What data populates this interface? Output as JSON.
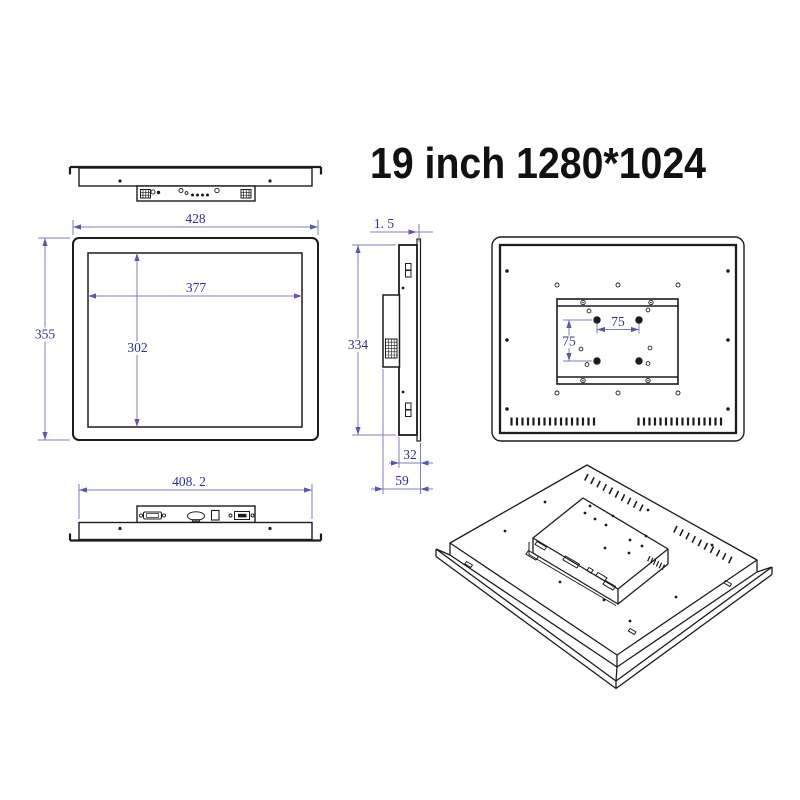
{
  "title": "19 inch 1280*1024",
  "colors": {
    "line": "#1c1c1c",
    "dim_line": "#7d7dc6",
    "dim_arrow": "#5757b5",
    "dim_text": "#2e2ea2",
    "title_text": "#111111",
    "background": "#ffffff"
  },
  "dims": {
    "front_width": "428",
    "front_height": "355",
    "screen_width": "377",
    "screen_height": "302",
    "bezel_thickness": "1. 5",
    "side_height": "334",
    "body_depth": "32",
    "total_depth": "59",
    "bottom_width": "408. 2",
    "vesa_horizontal": "75",
    "vesa_vertical": "75"
  }
}
